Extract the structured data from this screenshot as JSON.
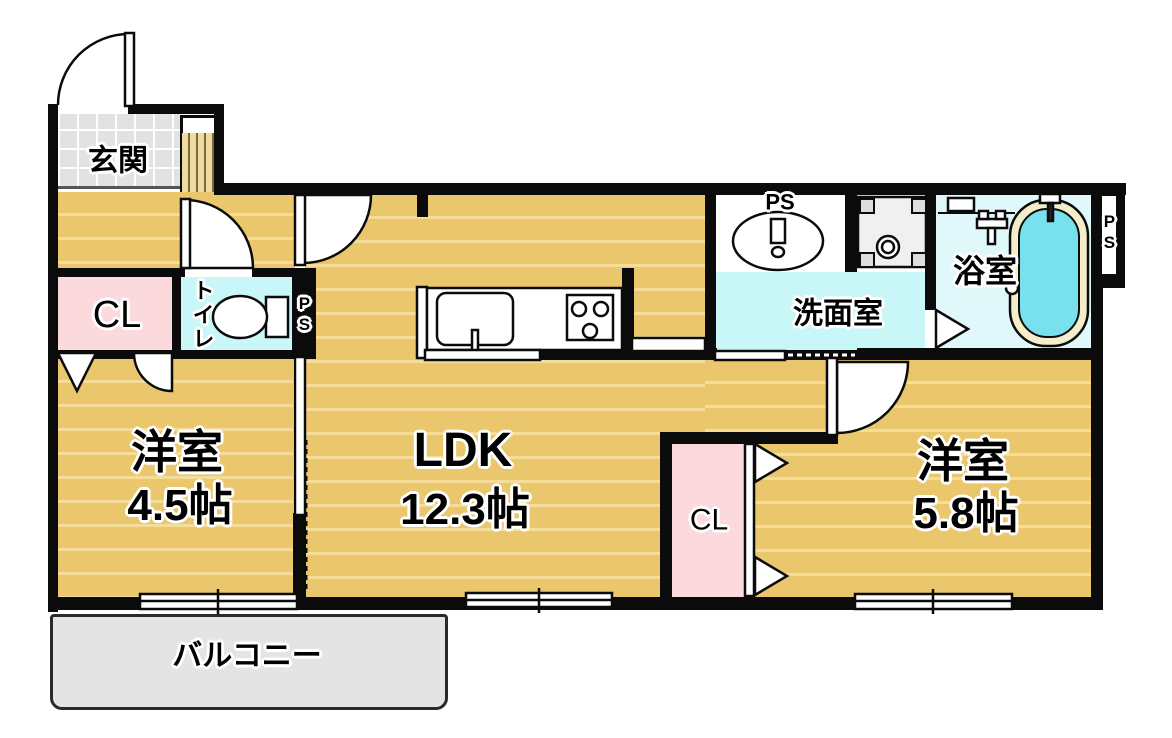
{
  "rooms": {
    "genkan": {
      "label": "玄関"
    },
    "closet_left": {
      "label": "CL"
    },
    "toilet": {
      "label": "トイレ"
    },
    "room45": {
      "label": "洋室",
      "size": "4.5帖"
    },
    "ldk": {
      "label": "LDK",
      "size": "12.3帖"
    },
    "senmen": {
      "label": "洗面室"
    },
    "bath": {
      "label": "浴室"
    },
    "closet_right": {
      "label": "CL"
    },
    "room58": {
      "label": "洋室",
      "size": "5.8帖"
    },
    "balcony": {
      "label": "バルコニー"
    }
  },
  "pipe_spaces": {
    "ps_toilet": "PS",
    "ps_vanity": "PS",
    "ps_right": "PS"
  },
  "colors": {
    "floor_wood": "#eac66c",
    "floor_stripe": "#f5dd97",
    "wet_room": "#c9f6f7",
    "bath_floor": "#e0f8fa",
    "closet_pink": "#fbd9dd",
    "entry_tile": "#e2e2e2",
    "balcony_gray": "#e4e4e4",
    "wall": "#0b0b0b",
    "tub_rim": "#f3edc9",
    "tub_water": "#79e1ed"
  }
}
